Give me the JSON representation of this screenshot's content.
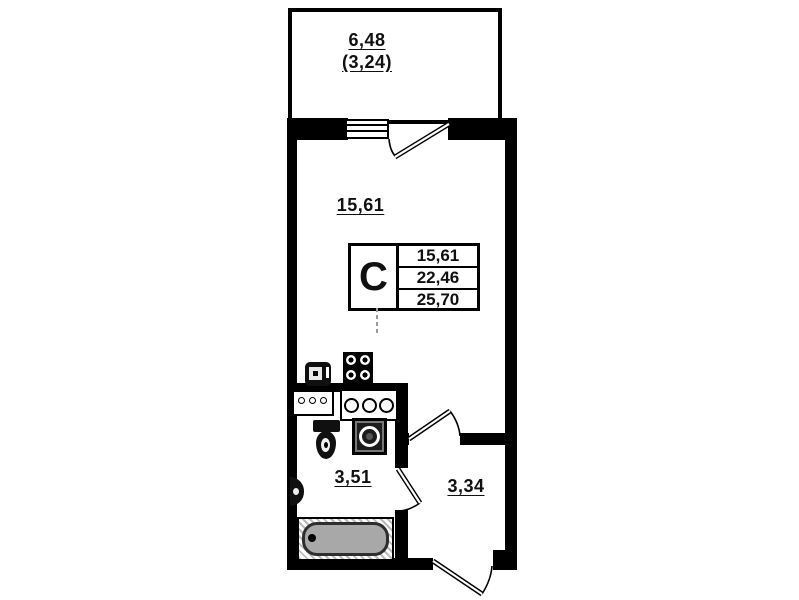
{
  "labels": {
    "balcony_area": "6,48",
    "balcony_area_secondary": "(3,24)",
    "room_area": "15,61",
    "bathroom_area": "3,51",
    "hall_area": "3,34"
  },
  "info_table": {
    "unit_type": "C",
    "values": [
      "15,61",
      "22,46",
      "25,70"
    ]
  },
  "colors": {
    "wall": "#000000",
    "bathtub_fill": "#a8a8a8",
    "paper": "#ffffff"
  },
  "icons": {
    "window-icon": "triple-line window symbol",
    "balcony-door-icon": "door leaf with swing arc",
    "room-door-icon": "door leaf with swing arc",
    "bathroom-door-icon": "door leaf with swing arc",
    "entrance-door-icon": "door leaf with swing arc",
    "stove-icon": "4-burner hob",
    "kitchen-sink-icon": "sink unit",
    "counter-icon": "counter with 3 small rings",
    "hob-icon": "counter with 3 rings",
    "toilet-icon": "toilet with tank",
    "washing-machine-icon": "front-load washer",
    "wall-sink-icon": "half-round wall basin",
    "bathtub-icon": "bathtub with drain"
  }
}
